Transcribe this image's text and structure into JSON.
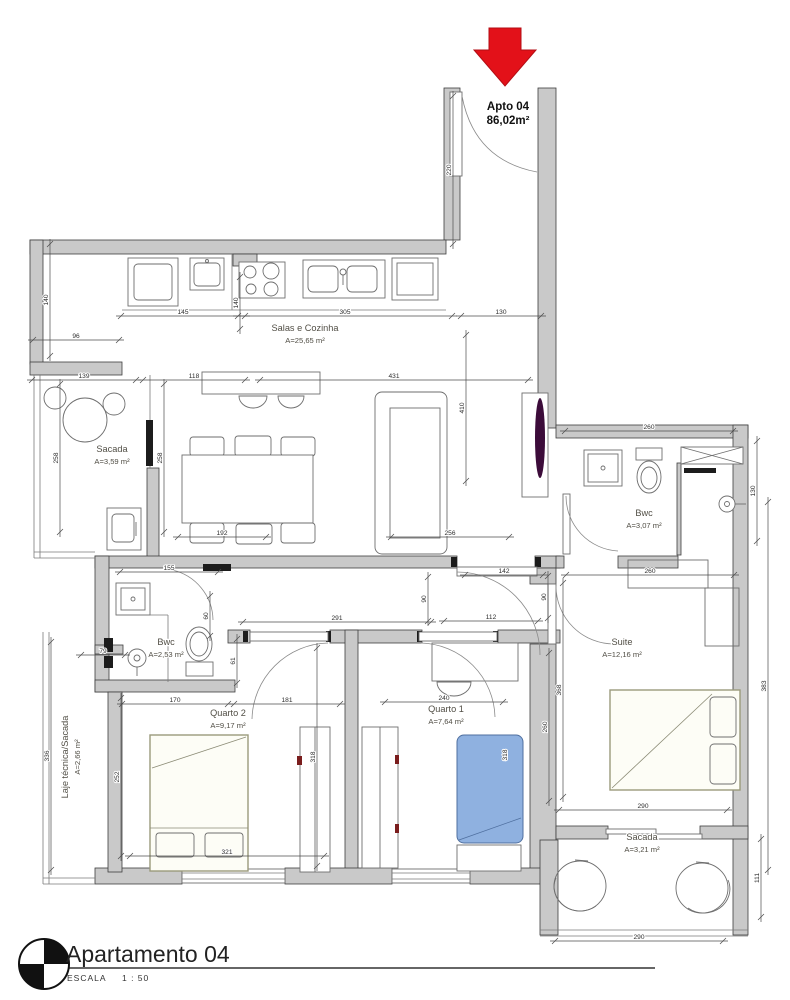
{
  "header": {
    "unit_label": "Apto 04",
    "unit_area": "86,02m²"
  },
  "title_block": {
    "title": "Apartamento 04",
    "scale_label": "ESCALA",
    "scale_value": "1 : 50"
  },
  "colors": {
    "wall_fill": "#c9c9c9",
    "arrow_red": "#e31119",
    "bed_blue": "#8fb1e0",
    "tv_purple": "#3c0c3a"
  },
  "rooms": [
    {
      "name": "Salas e Cozinha",
      "area": "A=25,65 m²",
      "x": 305,
      "y": 331,
      "rot": 0
    },
    {
      "name": "Sacada",
      "area": "A=3,59 m²",
      "x": 112,
      "y": 452,
      "rot": 0
    },
    {
      "name": "Bwc",
      "area": "A=3,07 m²",
      "x": 644,
      "y": 516,
      "rot": 0
    },
    {
      "name": "Suite",
      "area": "A=12,16 m²",
      "x": 622,
      "y": 645,
      "rot": 0
    },
    {
      "name": "Bwc",
      "area": "A=2,53 m²",
      "x": 166,
      "y": 645,
      "rot": 0
    },
    {
      "name": "Quarto 2",
      "area": "A=9,17 m²",
      "x": 228,
      "y": 716,
      "rot": 0
    },
    {
      "name": "Quarto 1",
      "area": "A=7,64 m²",
      "x": 446,
      "y": 712,
      "rot": 0
    },
    {
      "name": "Sacada",
      "area": "A=3,21 m²",
      "x": 642,
      "y": 840,
      "rot": 0
    },
    {
      "name": "Laje técnica/Sacada",
      "area": "A=2,66 m²",
      "x": 68,
      "y": 757,
      "rot": -90
    }
  ],
  "dims": [
    {
      "v": "220",
      "x": 449,
      "y": 170,
      "o": "v",
      "len": 148
    },
    {
      "v": "140",
      "x": 46,
      "y": 300,
      "o": "v",
      "len": 112
    },
    {
      "v": "96",
      "x": 76,
      "y": 336,
      "o": "h",
      "len": 86
    },
    {
      "v": "145",
      "x": 183,
      "y": 312,
      "o": "h",
      "len": 124
    },
    {
      "v": "140",
      "x": 236,
      "y": 303,
      "o": "v",
      "len": 52
    },
    {
      "v": "305",
      "x": 345,
      "y": 312,
      "o": "h",
      "len": 214
    },
    {
      "v": "130",
      "x": 501,
      "y": 312,
      "o": "h",
      "len": 80
    },
    {
      "v": "139",
      "x": 84,
      "y": 376,
      "o": "h",
      "len": 104
    },
    {
      "v": "118",
      "x": 194,
      "y": 376,
      "o": "h",
      "len": 102
    },
    {
      "v": "431",
      "x": 394,
      "y": 376,
      "o": "h",
      "len": 268
    },
    {
      "v": "258",
      "x": 56,
      "y": 458,
      "o": "v",
      "len": 148
    },
    {
      "v": "258",
      "x": 160,
      "y": 458,
      "o": "v",
      "len": 148
    },
    {
      "v": "410",
      "x": 462,
      "y": 408,
      "o": "v",
      "len": 146
    },
    {
      "v": "256",
      "x": 450,
      "y": 533,
      "o": "h",
      "len": 118
    },
    {
      "v": "192",
      "x": 222,
      "y": 533,
      "o": "h",
      "len": 88
    },
    {
      "v": "142",
      "x": 504,
      "y": 571,
      "o": "h",
      "len": 78
    },
    {
      "v": "90",
      "x": 424,
      "y": 599,
      "o": "v",
      "len": 44
    },
    {
      "v": "90",
      "x": 544,
      "y": 597,
      "o": "v",
      "len": 42
    },
    {
      "v": "112",
      "x": 491,
      "y": 617,
      "o": "h",
      "len": 94
    },
    {
      "v": "291",
      "x": 337,
      "y": 618,
      "o": "h",
      "len": 188
    },
    {
      "v": "61",
      "x": 233,
      "y": 661,
      "o": "v",
      "len": 44
    },
    {
      "v": "155",
      "x": 169,
      "y": 568,
      "o": "h",
      "len": 98
    },
    {
      "v": "60",
      "x": 206,
      "y": 616,
      "o": "v",
      "len": 40
    },
    {
      "v": "170",
      "x": 175,
      "y": 700,
      "o": "h",
      "len": 106
    },
    {
      "v": "181",
      "x": 287,
      "y": 700,
      "o": "h",
      "len": 106
    },
    {
      "v": "240",
      "x": 444,
      "y": 698,
      "o": "h",
      "len": 118
    },
    {
      "v": "79",
      "x": 103,
      "y": 651,
      "o": "h",
      "len": 44
    },
    {
      "v": "336",
      "x": 47,
      "y": 756,
      "o": "v",
      "len": 228
    },
    {
      "v": "252",
      "x": 117,
      "y": 777,
      "o": "v",
      "len": 158
    },
    {
      "v": "318",
      "x": 313,
      "y": 757,
      "o": "v",
      "len": 218
    },
    {
      "v": "321",
      "x": 227,
      "y": 852,
      "o": "h",
      "len": 194
    },
    {
      "v": "368",
      "x": 559,
      "y": 690,
      "o": "v",
      "len": 214
    },
    {
      "v": "260",
      "x": 545,
      "y": 727,
      "o": "v",
      "len": 148
    },
    {
      "v": "383",
      "x": 764,
      "y": 686,
      "o": "v",
      "len": 368
    },
    {
      "v": "130",
      "x": 753,
      "y": 491,
      "o": "v",
      "len": 100
    },
    {
      "v": "260",
      "x": 649,
      "y": 427,
      "o": "h",
      "len": 168
    },
    {
      "v": "260",
      "x": 650,
      "y": 571,
      "o": "h",
      "len": 168
    },
    {
      "v": "290",
      "x": 643,
      "y": 806,
      "o": "h",
      "len": 168
    },
    {
      "v": "290",
      "x": 639,
      "y": 937,
      "o": "h",
      "len": 168
    },
    {
      "v": "111",
      "x": 757,
      "y": 878,
      "o": "v",
      "len": 78
    },
    {
      "v": "318",
      "x": 505,
      "y": 755,
      "o": "v",
      "len": 0
    }
  ]
}
